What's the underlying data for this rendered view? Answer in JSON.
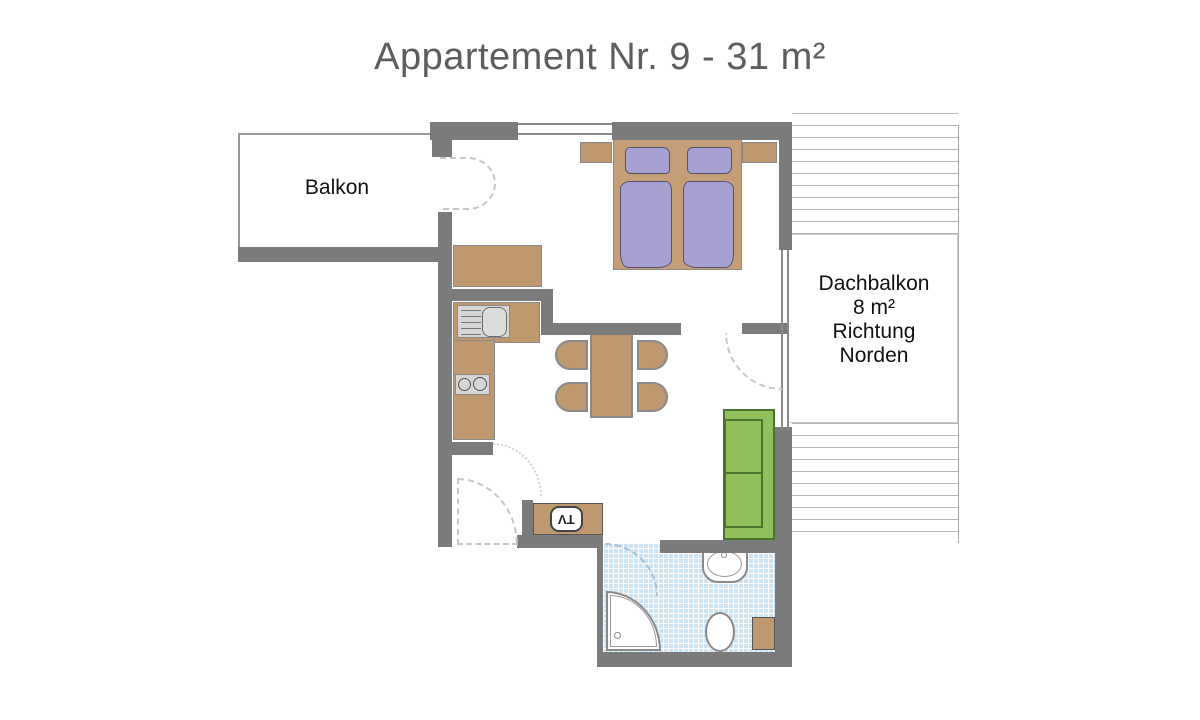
{
  "title": "Appartement Nr. 9 - 31 m²",
  "rooms": {
    "balcony": {
      "label": "Balkon"
    },
    "roof_balcony": {
      "lines": [
        "Dachbalkon",
        "8 m²",
        "Richtung",
        "Norden"
      ]
    }
  },
  "furniture": {
    "tv_label": "TV"
  },
  "colors": {
    "wall": "#7b7b7b",
    "outline": "#8a8a8a",
    "furniture": "#bf986f",
    "bed_textile": "#a7a1d1",
    "bed_textile_outline": "#565070",
    "sofa": "#90bf5c",
    "sofa_outline": "#4a742c",
    "tile": "#cfe4f2",
    "appliance": "#d6d6d6",
    "hatch": "#b3b3b3",
    "door_dash": "#c6c6c6",
    "title_text": "#5d5d5d",
    "label_text": "#111111"
  }
}
